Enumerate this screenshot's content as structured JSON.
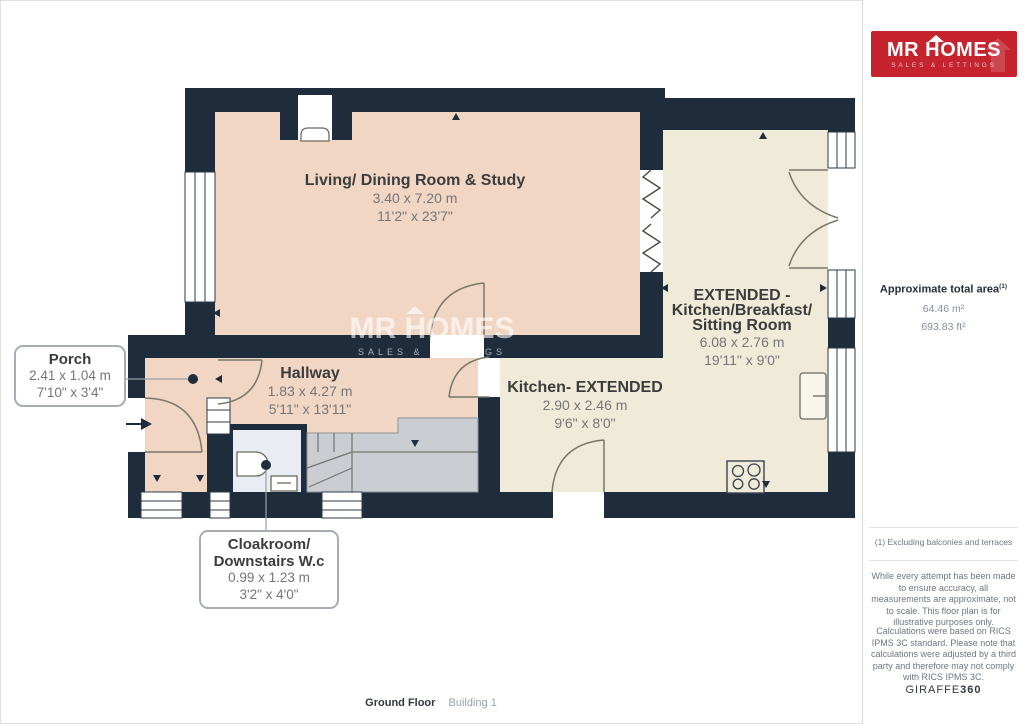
{
  "floorplan": {
    "watermark": {
      "brand": "MR HOMES",
      "tagline": "SALES & LETTINGS"
    },
    "rooms": {
      "living": {
        "name": "Living/ Dining Room & Study",
        "metric": "3.40 x 7.20 m",
        "imperial": "11'2\" x 23'7\""
      },
      "extended": {
        "name_line1": "EXTENDED -",
        "name_line2": "Kitchen/Breakfast/",
        "name_line3": "Sitting Room",
        "metric": "6.08 x 2.76 m",
        "imperial": "19'11\" x 9'0\""
      },
      "kitchen": {
        "name": "Kitchen- EXTENDED",
        "metric": "2.90 x 2.46 m",
        "imperial": "9'6\" x 8'0\""
      },
      "hallway": {
        "name": "Hallway",
        "metric": "1.83 x 4.27 m",
        "imperial": "5'11\" x 13'11\""
      },
      "porch": {
        "name": "Porch",
        "metric": "2.41 x 1.04 m",
        "imperial": "7'10\" x 3'4\""
      },
      "cloakroom": {
        "name_line1": "Cloakroom/",
        "name_line2": "Downstairs W.c",
        "metric": "0.99 x 1.23 m",
        "imperial": "3'2\" x 4'0\""
      }
    },
    "footer": {
      "floor": "Ground Floor",
      "building": "Building 1"
    }
  },
  "sidebar": {
    "logo": {
      "brand": "MR HOMES",
      "tagline": "SALES & LETTINGS"
    },
    "area": {
      "title": "Approximate total area",
      "footnote_marker": "(1)",
      "metric": "64.46 m²",
      "imperial": "693.83 ft²"
    },
    "note": "(1) Excluding balconies and terraces",
    "disclaimer_1": "While every attempt has been made to ensure accuracy, all measurements are approximate, not to scale. This floor plan is for illustrative purposes only.",
    "disclaimer_2": "Calculations were based on RICS IPMS 3C standard. Please note that calculations were adjusted by a third party and therefore may not comply with RICS IPMS 3C.",
    "brand_mark": {
      "name": "GIRAFFE",
      "suffix": "360"
    }
  },
  "colors": {
    "wall": "#1e2c3c",
    "room_warm": "#f2d6c4",
    "room_cream": "#f0ead8",
    "stairs": "#caced2",
    "cloakroom": "#e9ecf2",
    "logo_red": "#c5242f"
  }
}
